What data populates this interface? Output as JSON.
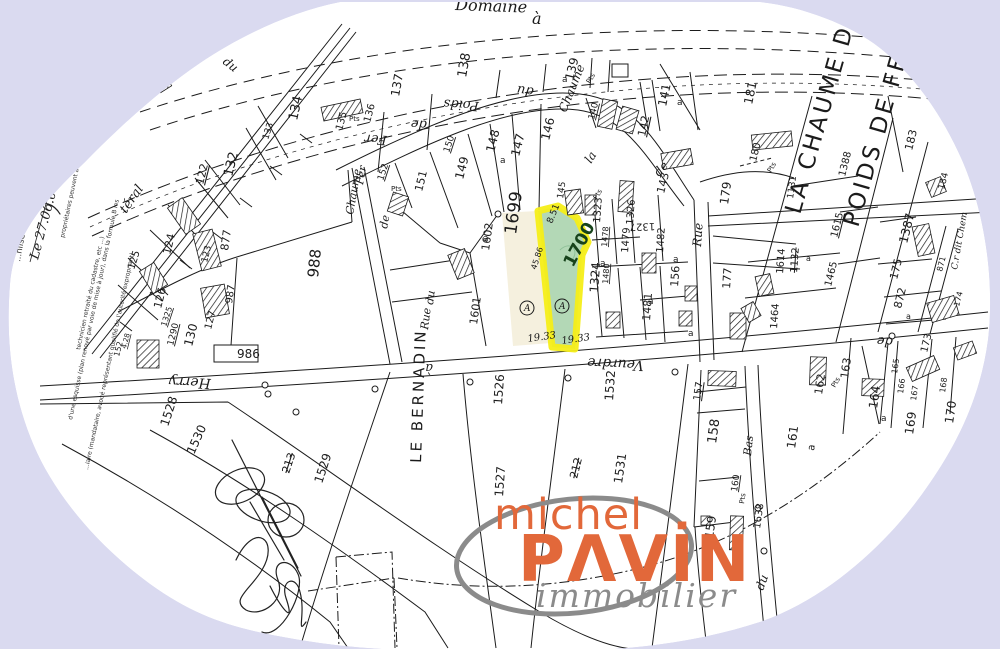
{
  "colors": {
    "background": "#dadaf0",
    "paper": "#ffffff",
    "ink": "#1b1b1b",
    "highlight_fill": "#a8d3ac",
    "highlight_stroke": "#f5ee18",
    "neighbor_fill": "#f3edd8",
    "logo_orange": "#e2683a",
    "logo_gray": "#8b8b8b"
  },
  "logo": {
    "top": "michel",
    "brand": "PAVIN",
    "brand_display": "PΛVİN",
    "tagline": "immobilier"
  },
  "margin": {
    "note": "...nlise 6463.",
    "date": "Le 27.06.07",
    "fine1": "propriétaires peuvent avoir effectué aux m",
    "fine2": "d'une esquisse (plan renové par voie de mise à jour), dans la formule B les",
    "fine3": "technicien retraité du cadastre, etc ...)",
    "fine4": "...iaire (mandataire, avoué représentant qualifié de l'autorité expropriant)"
  },
  "map": {
    "highlighted_parcel": "1700",
    "neighbor_parcel": "1699",
    "labels": [
      {
        "t": "Domaine",
        "x": 455,
        "y": 10,
        "r": 2,
        "s": 16,
        "c": "road"
      },
      {
        "t": "à",
        "x": 532,
        "y": 24,
        "r": 0,
        "s": 16,
        "c": "road"
      },
      {
        "t": "du",
        "x": 222,
        "y": 63,
        "r": 38,
        "s": 12,
        "c": "road"
      },
      {
        "t": "téral",
        "x": 126,
        "y": 214,
        "r": -55,
        "s": 13,
        "c": "road"
      },
      {
        "t": "Poids",
        "x": 479,
        "y": 102,
        "r": 184,
        "s": 13,
        "c": "road"
      },
      {
        "t": "du",
        "x": 534,
        "y": 88,
        "r": 188,
        "s": 13,
        "c": "road"
      },
      {
        "t": "de",
        "x": 427,
        "y": 121,
        "r": 184,
        "s": 13,
        "c": "road"
      },
      {
        "t": "Fer",
        "x": 387,
        "y": 136,
        "r": 184,
        "s": 13,
        "c": "road"
      },
      {
        "t": "Chaume",
        "x": 566,
        "y": 113,
        "r": -68,
        "s": 12,
        "c": "road"
      },
      {
        "t": "la",
        "x": 591,
        "y": 164,
        "r": -58,
        "s": 12,
        "c": "road"
      },
      {
        "t": "de",
        "x": 659,
        "y": 177,
        "r": -48,
        "s": 12,
        "c": "road"
      },
      {
        "t": "Fer",
        "x": 363,
        "y": 185,
        "r": -80,
        "s": 11,
        "c": "road"
      },
      {
        "t": "Chaume",
        "x": 353,
        "y": 215,
        "r": -80,
        "s": 11,
        "c": "road"
      },
      {
        "t": "de",
        "x": 387,
        "y": 229,
        "r": -80,
        "s": 11,
        "c": "road"
      },
      {
        "t": "du",
        "x": 433,
        "y": 305,
        "r": -83,
        "s": 11,
        "c": "road"
      },
      {
        "t": "Rue",
        "x": 428,
        "y": 330,
        "r": -83,
        "s": 11,
        "c": "road"
      },
      {
        "t": "Rue",
        "x": 701,
        "y": 247,
        "r": -86,
        "s": 12,
        "c": "road"
      },
      {
        "t": "Herry",
        "x": 211,
        "y": 379,
        "r": 183,
        "s": 14,
        "c": "road"
      },
      {
        "t": "à",
        "x": 433,
        "y": 364,
        "r": 180,
        "s": 13,
        "c": "road"
      },
      {
        "t": "Veurdre",
        "x": 644,
        "y": 361,
        "r": 183,
        "s": 14,
        "c": "road"
      },
      {
        "t": "de",
        "x": 893,
        "y": 338,
        "r": 184,
        "s": 13,
        "c": "road"
      },
      {
        "t": "Bas",
        "x": 751,
        "y": 456,
        "r": -84,
        "s": 11,
        "c": "road"
      },
      {
        "t": "du",
        "x": 763,
        "y": 591,
        "r": -70,
        "s": 12,
        "c": "road"
      },
      {
        "t": "C.r dit Chem",
        "x": 957,
        "y": 270,
        "r": -80,
        "s": 9,
        "c": "road"
      },
      {
        "t": "LE BERNADIN",
        "x": 421,
        "y": 463,
        "r": -88,
        "s": 15,
        "c": "big"
      },
      {
        "t": "LA CHAUME DU",
        "x": 800,
        "y": 215,
        "r": -74,
        "s": 23,
        "c": "big"
      },
      {
        "t": "POIDS DE FER",
        "x": 858,
        "y": 228,
        "r": -74,
        "s": 23,
        "c": "big"
      },
      {
        "t": "137",
        "x": 399,
        "y": 97,
        "r": -80,
        "s": 12
      },
      {
        "t": "138",
        "x": 466,
        "y": 78,
        "r": -80,
        "s": 13
      },
      {
        "t": "a",
        "x": 562,
        "y": 82,
        "r": 0,
        "s": 9
      },
      {
        "t": "139",
        "x": 573,
        "y": 81,
        "r": -76,
        "s": 12
      },
      {
        "t": "Pts",
        "x": 590,
        "y": 84,
        "r": -60,
        "s": 7
      },
      {
        "t": "140",
        "x": 594,
        "y": 120,
        "r": -76,
        "s": 9,
        "c": "u"
      },
      {
        "t": "141",
        "x": 666,
        "y": 107,
        "r": -78,
        "s": 12
      },
      {
        "t": "a",
        "x": 677,
        "y": 105,
        "r": 0,
        "s": 9
      },
      {
        "t": "142",
        "x": 645,
        "y": 137,
        "r": -78,
        "s": 11,
        "c": "u"
      },
      {
        "t": "143",
        "x": 664,
        "y": 194,
        "r": -76,
        "s": 11
      },
      {
        "t": "145",
        "x": 563,
        "y": 199,
        "r": -82,
        "s": 9
      },
      {
        "t": "Pts",
        "x": 597,
        "y": 200,
        "r": -60,
        "s": 7
      },
      {
        "t": "146",
        "x": 549,
        "y": 141,
        "r": -76,
        "s": 12
      },
      {
        "t": "147",
        "x": 519,
        "y": 157,
        "r": -76,
        "s": 12
      },
      {
        "t": "148",
        "x": 494,
        "y": 153,
        "r": -76,
        "s": 12
      },
      {
        "t": "a",
        "x": 500,
        "y": 163,
        "r": 0,
        "s": 9
      },
      {
        "t": "149",
        "x": 463,
        "y": 180,
        "r": -76,
        "s": 12
      },
      {
        "t": "150",
        "x": 449,
        "y": 153,
        "r": -72,
        "s": 9,
        "c": "u"
      },
      {
        "t": "151",
        "x": 422,
        "y": 192,
        "r": -76,
        "s": 11
      },
      {
        "t": "152",
        "x": 383,
        "y": 181,
        "r": -72,
        "s": 9,
        "c": "u"
      },
      {
        "t": "Pts",
        "x": 391,
        "y": 191,
        "r": 0,
        "s": 7
      },
      {
        "t": "Pts",
        "x": 349,
        "y": 121,
        "r": 0,
        "s": 7
      },
      {
        "t": "134",
        "x": 297,
        "y": 121,
        "r": -78,
        "s": 13
      },
      {
        "t": "135",
        "x": 342,
        "y": 131,
        "r": -75,
        "s": 10
      },
      {
        "t": "136",
        "x": 370,
        "y": 123,
        "r": -75,
        "s": 10
      },
      {
        "t": "133",
        "x": 268,
        "y": 140,
        "r": -72,
        "s": 9
      },
      {
        "t": "132",
        "x": 232,
        "y": 177,
        "r": -76,
        "s": 13
      },
      {
        "t": "122",
        "x": 203,
        "y": 185,
        "r": -76,
        "s": 11,
        "c": "u"
      },
      {
        "t": "877",
        "x": 228,
        "y": 251,
        "r": -82,
        "s": 11
      },
      {
        "t": "124",
        "x": 170,
        "y": 255,
        "r": -76,
        "s": 11
      },
      {
        "t": "125",
        "x": 134,
        "y": 270,
        "r": -72,
        "s": 10
      },
      {
        "t": "126",
        "x": 161,
        "y": 309,
        "r": -76,
        "s": 11
      },
      {
        "t": "123",
        "x": 207,
        "y": 263,
        "r": -76,
        "s": 9
      },
      {
        "t": "987",
        "x": 232,
        "y": 304,
        "r": -82,
        "s": 10
      },
      {
        "t": "988",
        "x": 318,
        "y": 278,
        "r": -84,
        "s": 15
      },
      {
        "t": "986",
        "x": 237,
        "y": 358,
        "r": 0,
        "s": 12
      },
      {
        "t": "130",
        "x": 192,
        "y": 347,
        "r": -76,
        "s": 12
      },
      {
        "t": "127",
        "x": 211,
        "y": 330,
        "r": -76,
        "s": 10
      },
      {
        "t": "1290",
        "x": 173,
        "y": 346,
        "r": -76,
        "s": 9,
        "c": "u"
      },
      {
        "t": "1325",
        "x": 166,
        "y": 327,
        "r": -72,
        "s": 8,
        "c": "u"
      },
      {
        "t": "152",
        "x": 119,
        "y": 357,
        "r": -76,
        "s": 8
      },
      {
        "t": "4.28",
        "x": 126,
        "y": 349,
        "r": -76,
        "s": 7,
        "c": "u"
      },
      {
        "t": "1528",
        "x": 168,
        "y": 427,
        "r": -72,
        "s": 12
      },
      {
        "t": "1530",
        "x": 194,
        "y": 455,
        "r": -66,
        "s": 12
      },
      {
        "t": "213",
        "x": 289,
        "y": 474,
        "r": -72,
        "s": 11,
        "c": "k"
      },
      {
        "t": "1529",
        "x": 322,
        "y": 484,
        "r": -72,
        "s": 12
      },
      {
        "t": "1526",
        "x": 502,
        "y": 405,
        "r": -86,
        "s": 12
      },
      {
        "t": "1527",
        "x": 503,
        "y": 497,
        "r": -86,
        "s": 12
      },
      {
        "t": "212",
        "x": 577,
        "y": 479,
        "r": -76,
        "s": 11,
        "c": "k"
      },
      {
        "t": "1531",
        "x": 622,
        "y": 484,
        "r": -82,
        "s": 12
      },
      {
        "t": "1532",
        "x": 613,
        "y": 401,
        "r": -86,
        "s": 12
      },
      {
        "t": "1699",
        "x": 516,
        "y": 235,
        "r": -82,
        "s": 17
      },
      {
        "t": "1700",
        "x": 573,
        "y": 268,
        "r": -62,
        "s": 17,
        "c": "green"
      },
      {
        "t": "8.51",
        "x": 552,
        "y": 224,
        "r": -68,
        "s": 9
      },
      {
        "t": "45.86",
        "x": 536,
        "y": 270,
        "r": -72,
        "s": 8
      },
      {
        "t": "A",
        "x": 524,
        "y": 311,
        "r": 0,
        "s": 9,
        "c": "circ"
      },
      {
        "t": "A",
        "x": 559,
        "y": 309,
        "r": 0,
        "s": 9,
        "c": "circ"
      },
      {
        "t": "19.33",
        "x": 528,
        "y": 342,
        "r": -8,
        "s": 10,
        "c": "dim"
      },
      {
        "t": "19.33",
        "x": 562,
        "y": 344,
        "r": -8,
        "s": 10,
        "c": "dim"
      },
      {
        "t": "1601",
        "x": 477,
        "y": 325,
        "r": -82,
        "s": 11
      },
      {
        "t": "1602",
        "x": 489,
        "y": 251,
        "r": -82,
        "s": 11
      },
      {
        "t": "a",
        "x": 483,
        "y": 241,
        "r": 0,
        "s": 9
      },
      {
        "t": "1323",
        "x": 600,
        "y": 223,
        "r": -86,
        "s": 10
      },
      {
        "t": "1326",
        "x": 633,
        "y": 225,
        "r": -86,
        "s": 10
      },
      {
        "t": "1327",
        "x": 655,
        "y": 223,
        "r": 178,
        "s": 10
      },
      {
        "t": "1478",
        "x": 607,
        "y": 247,
        "r": -86,
        "s": 8,
        "c": "u"
      },
      {
        "t": "1479",
        "x": 628,
        "y": 253,
        "r": -86,
        "s": 10
      },
      {
        "t": "1480",
        "x": 608,
        "y": 284,
        "r": -86,
        "s": 8,
        "c": "u"
      },
      {
        "t": "1324",
        "x": 598,
        "y": 293,
        "r": -86,
        "s": 12
      },
      {
        "t": "a",
        "x": 600,
        "y": 266,
        "r": 0,
        "s": 9
      },
      {
        "t": "1482",
        "x": 663,
        "y": 253,
        "r": -86,
        "s": 10
      },
      {
        "t": "a",
        "x": 673,
        "y": 262,
        "r": 0,
        "s": 9
      },
      {
        "t": "156",
        "x": 678,
        "y": 287,
        "r": -86,
        "s": 11
      },
      {
        "t": "a",
        "x": 688,
        "y": 336,
        "r": 0,
        "s": 9
      },
      {
        "t": "1481",
        "x": 650,
        "y": 321,
        "r": -86,
        "s": 11
      },
      {
        "t": "a",
        "x": 648,
        "y": 304,
        "r": 0,
        "s": 9
      },
      {
        "t": "177",
        "x": 730,
        "y": 289,
        "r": -86,
        "s": 11
      },
      {
        "t": "1464",
        "x": 777,
        "y": 329,
        "r": -86,
        "s": 10
      },
      {
        "t": "1614",
        "x": 783,
        "y": 274,
        "r": -86,
        "s": 10
      },
      {
        "t": "1132",
        "x": 797,
        "y": 273,
        "r": -86,
        "s": 10,
        "c": "k"
      },
      {
        "t": "a",
        "x": 806,
        "y": 261,
        "r": 0,
        "s": 8
      },
      {
        "t": "1615",
        "x": 837,
        "y": 238,
        "r": -76,
        "s": 10,
        "c": "u"
      },
      {
        "t": "1465",
        "x": 831,
        "y": 287,
        "r": -76,
        "s": 10
      },
      {
        "t": "1388",
        "x": 845,
        "y": 177,
        "r": -76,
        "s": 10
      },
      {
        "t": "179",
        "x": 728,
        "y": 205,
        "r": -82,
        "s": 12
      },
      {
        "t": "180",
        "x": 756,
        "y": 162,
        "r": -76,
        "s": 10
      },
      {
        "t": "Pts",
        "x": 771,
        "y": 173,
        "r": -60,
        "s": 7
      },
      {
        "t": "1131",
        "x": 793,
        "y": 199,
        "r": -82,
        "s": 9
      },
      {
        "t": "181",
        "x": 752,
        "y": 105,
        "r": -78,
        "s": 12
      },
      {
        "t": "183",
        "x": 912,
        "y": 151,
        "r": -76,
        "s": 11
      },
      {
        "t": "184",
        "x": 944,
        "y": 190,
        "r": -76,
        "s": 9
      },
      {
        "t": "1387",
        "x": 907,
        "y": 244,
        "r": -76,
        "s": 12
      },
      {
        "t": "175",
        "x": 897,
        "y": 280,
        "r": -76,
        "s": 11
      },
      {
        "t": "871",
        "x": 942,
        "y": 272,
        "r": -76,
        "s": 8
      },
      {
        "t": "872",
        "x": 901,
        "y": 309,
        "r": -76,
        "s": 11
      },
      {
        "t": "a",
        "x": 906,
        "y": 319,
        "r": 0,
        "s": 8
      },
      {
        "t": "174",
        "x": 959,
        "y": 307,
        "r": -76,
        "s": 8
      },
      {
        "t": "157",
        "x": 700,
        "y": 401,
        "r": -82,
        "s": 10,
        "c": "u"
      },
      {
        "t": "158",
        "x": 716,
        "y": 444,
        "r": -82,
        "s": 13
      },
      {
        "t": "161",
        "x": 795,
        "y": 449,
        "r": -82,
        "s": 12
      },
      {
        "t": "a",
        "x": 814,
        "y": 451,
        "r": -82,
        "s": 10
      },
      {
        "t": "162",
        "x": 822,
        "y": 395,
        "r": -82,
        "s": 11
      },
      {
        "t": "Pts",
        "x": 835,
        "y": 388,
        "r": -60,
        "s": 7
      },
      {
        "t": "163",
        "x": 848,
        "y": 379,
        "r": -82,
        "s": 11
      },
      {
        "t": "164",
        "x": 877,
        "y": 409,
        "r": -82,
        "s": 12
      },
      {
        "t": "a",
        "x": 881,
        "y": 421,
        "r": 0,
        "s": 9
      },
      {
        "t": "165",
        "x": 897,
        "y": 374,
        "r": -82,
        "s": 8
      },
      {
        "t": "166",
        "x": 903,
        "y": 394,
        "r": -82,
        "s": 8
      },
      {
        "t": "167",
        "x": 916,
        "y": 401,
        "r": -82,
        "s": 8
      },
      {
        "t": "168",
        "x": 945,
        "y": 393,
        "r": -82,
        "s": 8
      },
      {
        "t": "169",
        "x": 913,
        "y": 435,
        "r": -82,
        "s": 12
      },
      {
        "t": "170",
        "x": 953,
        "y": 424,
        "r": -82,
        "s": 12
      },
      {
        "t": "173",
        "x": 927,
        "y": 353,
        "r": -76,
        "s": 10
      },
      {
        "t": "160",
        "x": 737,
        "y": 492,
        "r": -82,
        "s": 9,
        "c": "u"
      },
      {
        "t": "Pts",
        "x": 744,
        "y": 504,
        "r": -82,
        "s": 7
      },
      {
        "t": "159",
        "x": 713,
        "y": 539,
        "r": -82,
        "s": 12
      },
      {
        "t": "1638",
        "x": 760,
        "y": 529,
        "r": -82,
        "s": 10
      }
    ],
    "buildings": [
      [
        322,
        103,
        40,
        14,
        -12
      ],
      [
        157,
        80,
        13,
        10,
        -32
      ],
      [
        175,
        200,
        18,
        32,
        -35
      ],
      [
        390,
        194,
        16,
        20,
        18
      ],
      [
        452,
        251,
        18,
        26,
        -22
      ],
      [
        566,
        190,
        16,
        24,
        -8
      ],
      [
        600,
        100,
        15,
        28,
        12
      ],
      [
        619,
        108,
        17,
        24,
        16
      ],
      [
        662,
        151,
        30,
        16,
        -10
      ],
      [
        752,
        133,
        40,
        15,
        -6
      ],
      [
        585,
        195,
        11,
        20,
        0
      ],
      [
        619,
        181,
        14,
        31,
        4
      ],
      [
        642,
        253,
        14,
        20,
        0
      ],
      [
        685,
        286,
        12,
        15,
        0
      ],
      [
        679,
        311,
        13,
        15,
        0
      ],
      [
        606,
        312,
        14,
        16,
        0
      ],
      [
        730,
        313,
        16,
        26,
        0
      ],
      [
        757,
        275,
        15,
        20,
        -12
      ],
      [
        744,
        304,
        14,
        16,
        -30
      ],
      [
        915,
        225,
        17,
        30,
        -12
      ],
      [
        928,
        179,
        16,
        16,
        -22
      ],
      [
        929,
        299,
        28,
        20,
        -16
      ],
      [
        908,
        361,
        30,
        15,
        -24
      ],
      [
        955,
        344,
        20,
        13,
        -20
      ],
      [
        810,
        357,
        16,
        28,
        2
      ],
      [
        862,
        379,
        22,
        17,
        2
      ],
      [
        708,
        371,
        28,
        15,
        2
      ],
      [
        730,
        516,
        13,
        34,
        2
      ],
      [
        701,
        516,
        9,
        9,
        0
      ],
      [
        145,
        265,
        17,
        26,
        -32
      ],
      [
        197,
        231,
        20,
        38,
        -14
      ],
      [
        203,
        286,
        24,
        30,
        -10
      ],
      [
        137,
        340,
        22,
        28,
        0
      ]
    ]
  }
}
